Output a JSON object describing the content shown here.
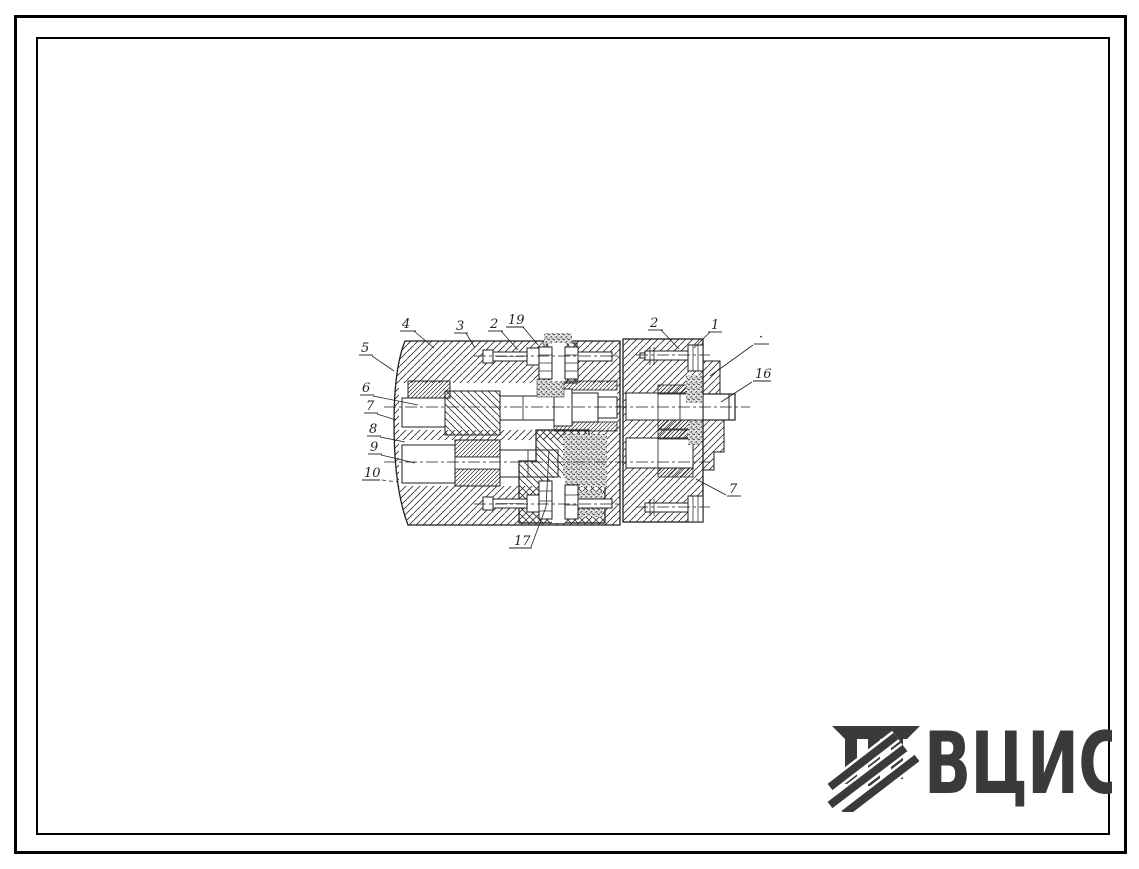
{
  "page": {
    "kind": "scanned-technical-drawing-sheet"
  },
  "colors": {
    "ink": "#1f1f1f",
    "paper": "#ffffff",
    "logo": "#3a3a3c"
  },
  "drawing": {
    "type": "mechanical-assembly-cross-section",
    "labels": [
      {
        "text": "4"
      },
      {
        "text": "3"
      },
      {
        "text": "2"
      },
      {
        "text": "19"
      },
      {
        "text": "2"
      },
      {
        "text": "1"
      },
      {
        "text": "·"
      },
      {
        "text": "16"
      },
      {
        "text": "7"
      },
      {
        "text": "17"
      },
      {
        "text": "5"
      },
      {
        "text": "6"
      },
      {
        "text": "7"
      },
      {
        "text": "8"
      },
      {
        "text": "9"
      },
      {
        "text": "10"
      }
    ]
  },
  "logo": {
    "text": "ВЦИС",
    "mark": "hatched-column-icon",
    "color": "#3a3a3c"
  }
}
